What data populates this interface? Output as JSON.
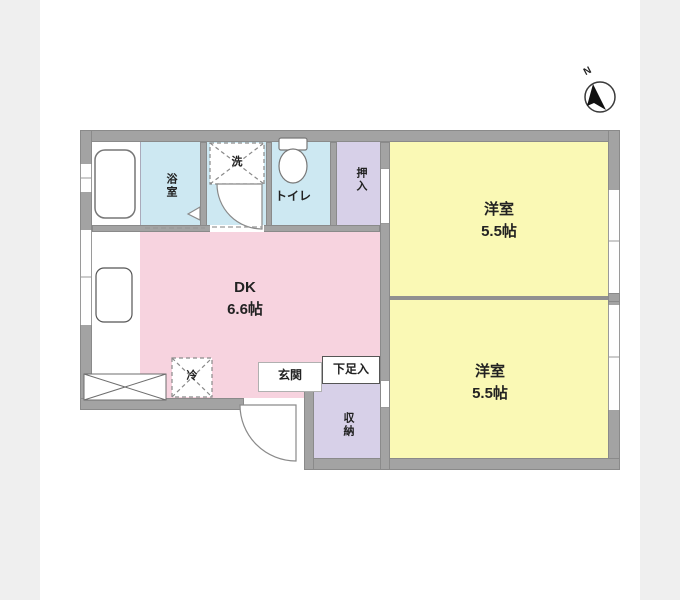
{
  "compass": {
    "north_label": "N"
  },
  "colors": {
    "room_yellow": "#faf9b5",
    "dk_pink": "#f7d3df",
    "wet_area_blue": "#cde8f2",
    "closet_lavender": "#d7d0e8",
    "wall_gray": "#a3a3a3",
    "outside_gray": "#efefef"
  },
  "rooms": {
    "bath": {
      "label": "浴室"
    },
    "washer": {
      "label": "洗"
    },
    "toilet": {
      "label": "トイレ"
    },
    "closet_top": {
      "label": "押入"
    },
    "western_top": {
      "name": "洋室",
      "size": "5.5帖"
    },
    "dk": {
      "name": "DK",
      "size": "6.6帖"
    },
    "fridge": {
      "label": "冷"
    },
    "entrance": {
      "label": "玄関"
    },
    "shoe_box": {
      "label": "下足入"
    },
    "storage": {
      "label": "収納"
    },
    "western_bottom": {
      "name": "洋室",
      "size": "5.5帖"
    }
  }
}
